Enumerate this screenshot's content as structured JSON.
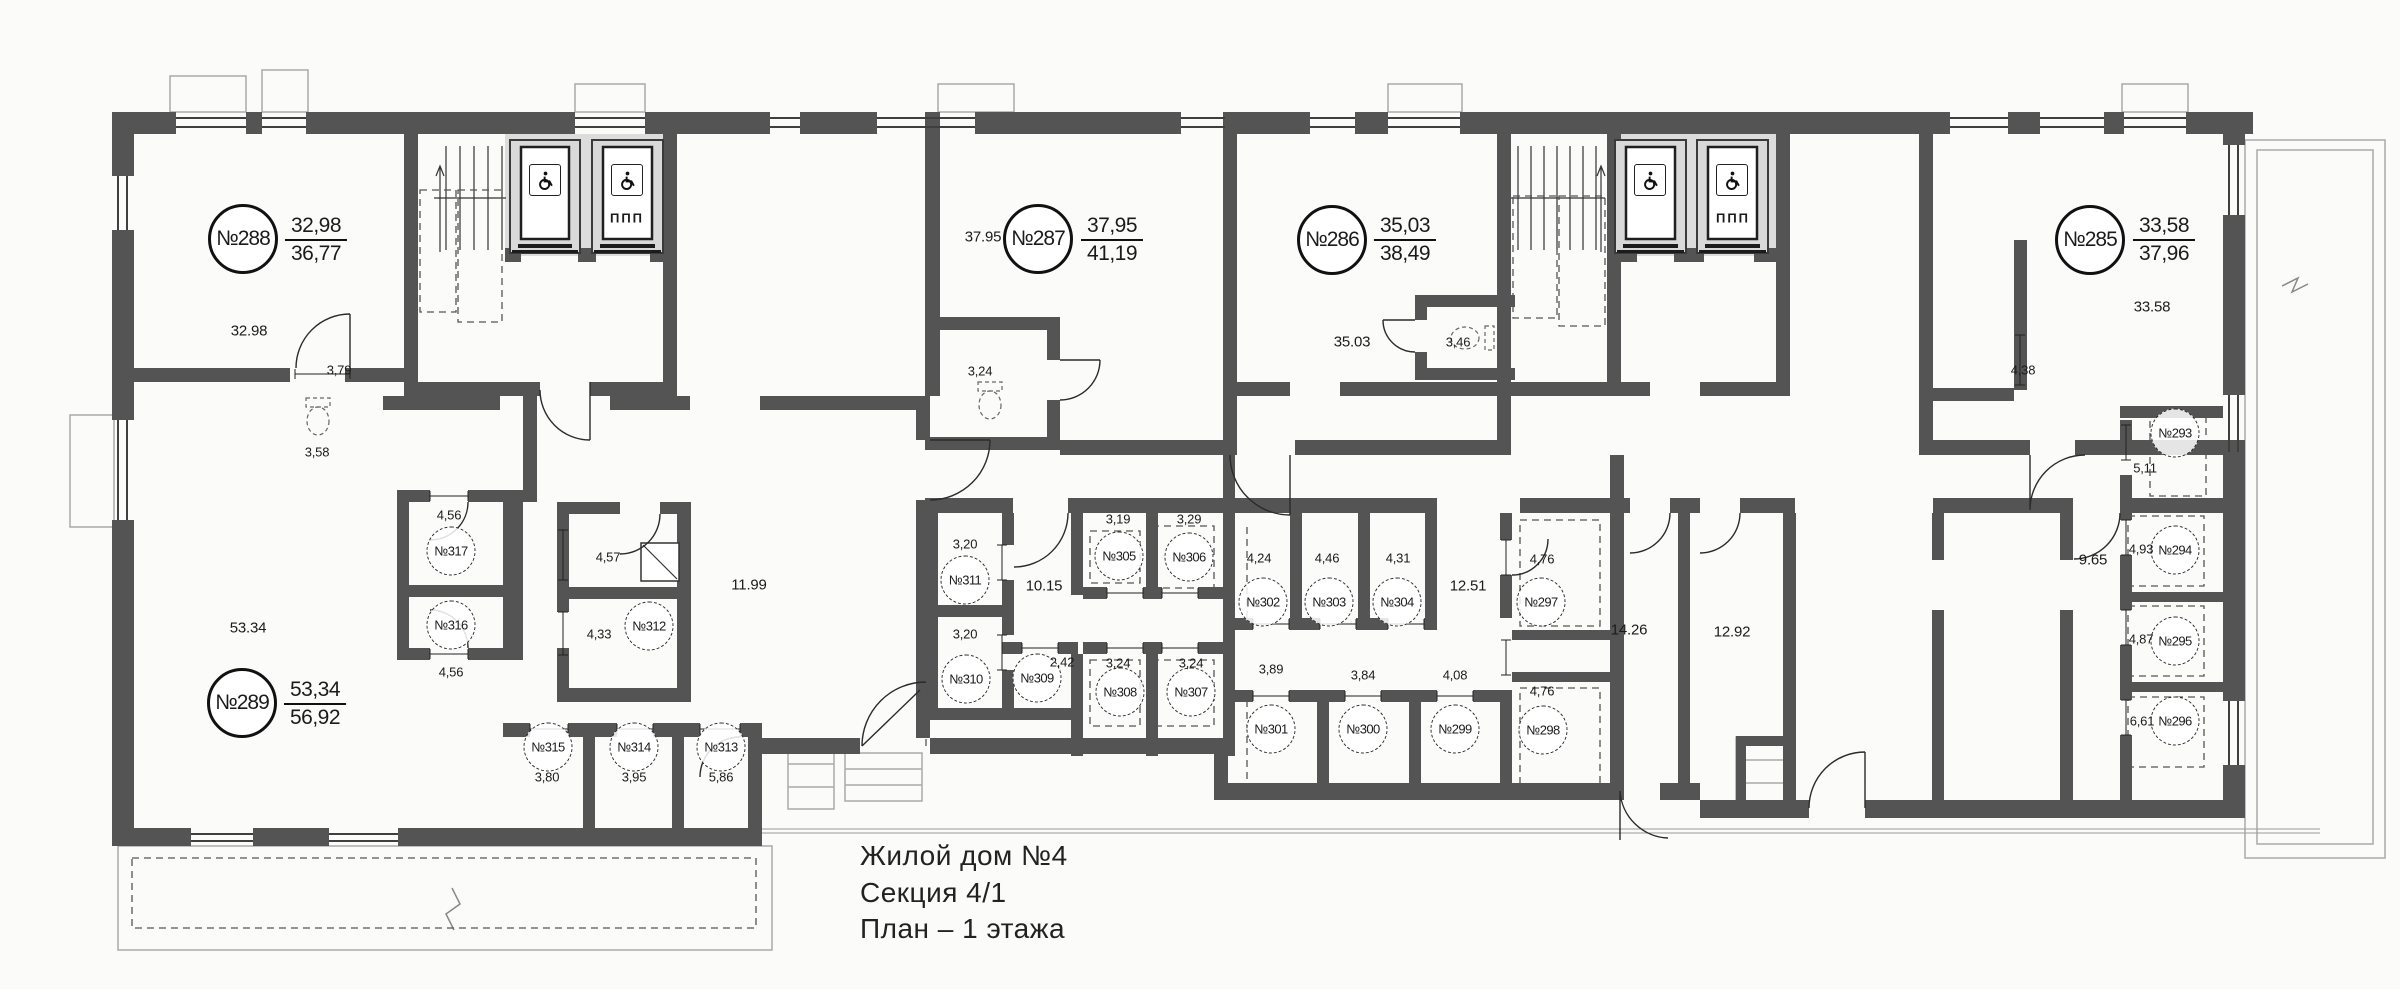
{
  "colors": {
    "wall": "#545454",
    "lobby": "#dcdcdc",
    "line": "#2b2b2b",
    "text": "#1b1b1b"
  },
  "title_block": {
    "line1": "Жилой дом №4",
    "line2": "Секция 4/1",
    "line3": "План – 1 этажа"
  },
  "apartments": [
    {
      "number": "№288",
      "area_top": "32,98",
      "area_bottom": "36,77"
    },
    {
      "number": "№287",
      "area_top": "37,95",
      "area_bottom": "41,19"
    },
    {
      "number": "№286",
      "area_top": "35,03",
      "area_bottom": "38,49"
    },
    {
      "number": "№285",
      "area_top": "33,58",
      "area_bottom": "37,96"
    },
    {
      "number": "№289",
      "area_top": "53,34",
      "area_bottom": "56,92"
    }
  ],
  "rooms": [
    "№317",
    "№316",
    "№312",
    "№315",
    "№314",
    "№313",
    "№311",
    "№310",
    "№309",
    "№305",
    "№306",
    "№308",
    "№307",
    "№302",
    "№303",
    "№304",
    "№297",
    "№301",
    "№300",
    "№299",
    "№298",
    "№293",
    "№294",
    "№295",
    "№296"
  ],
  "areas": [
    "32.98",
    "3,79",
    "3,58",
    "4,56",
    "4,56",
    "4,57",
    "4,33",
    "3,80",
    "3,95",
    "5,86",
    "53.34",
    "11.99",
    "3,20",
    "3,20",
    "10.15",
    "2,42",
    "3,19",
    "3,29",
    "3,24",
    "3,24",
    "4,24",
    "4,46",
    "4,31",
    "12.51",
    "4,76",
    "3,89",
    "3,84",
    "4,08",
    "4,76",
    "14.26",
    "12.92",
    "37.95",
    "3,24",
    "35.03",
    "3,46",
    "33.58",
    "4,38",
    "5,11",
    "9.65",
    "4,93",
    "4,87",
    "6,61"
  ],
  "elevators": {
    "ppp_label": "ППП",
    "icon": "wheelchair-icon"
  }
}
